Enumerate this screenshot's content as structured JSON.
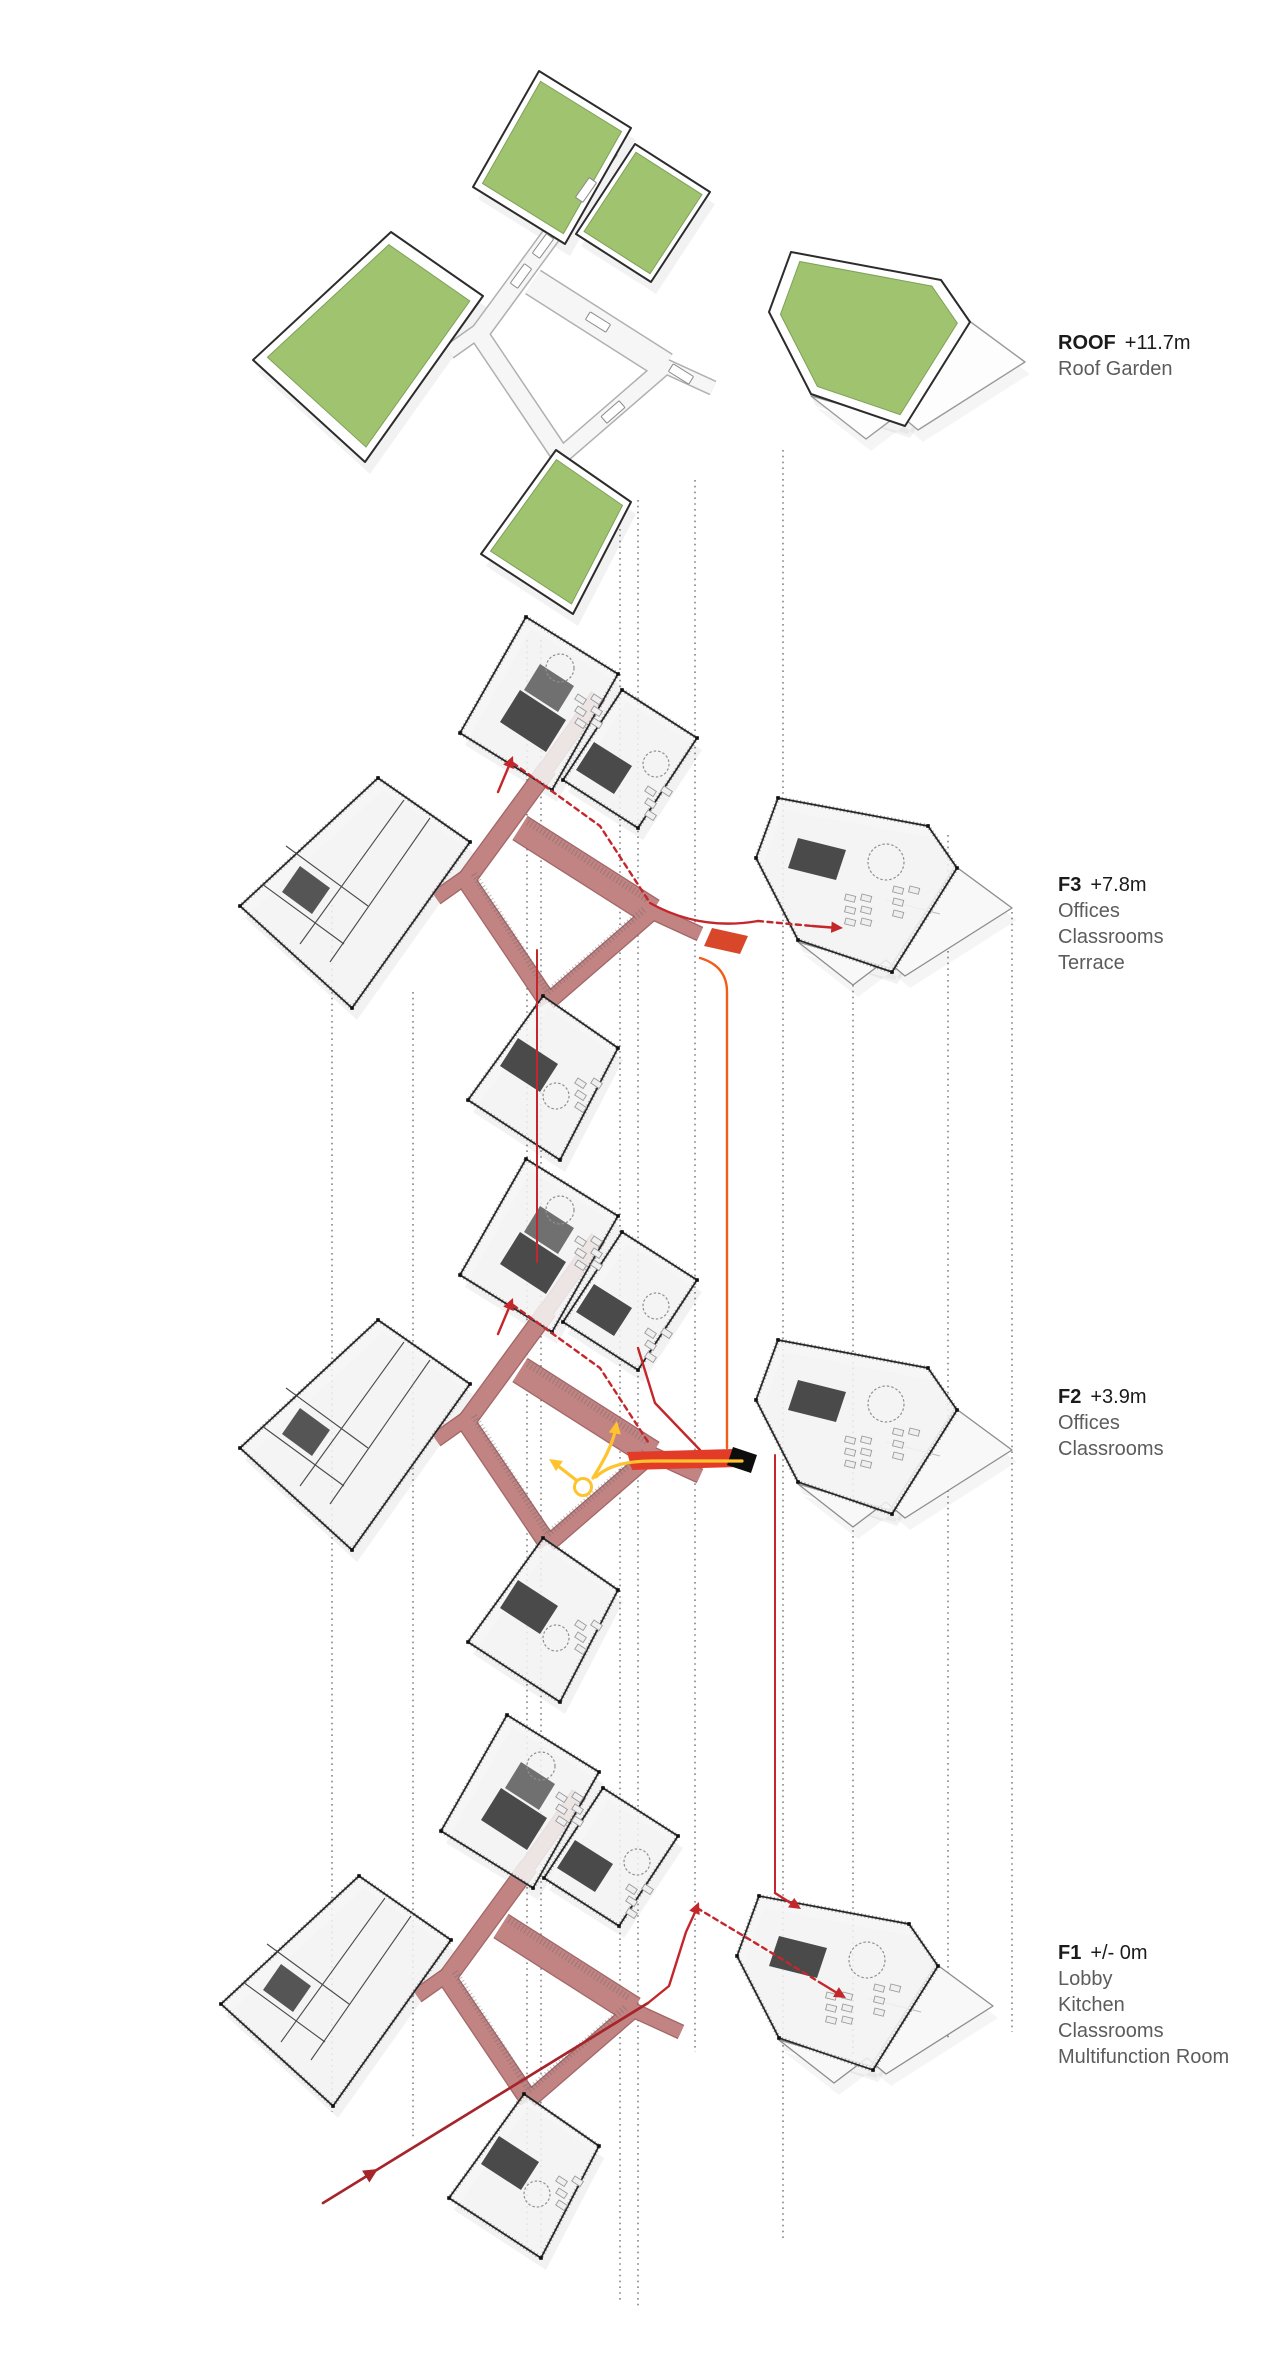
{
  "page": {
    "type": "exploded-axonometric-floor-diagram",
    "background": "#ffffff"
  },
  "colors": {
    "roof_green": "#9fc36f",
    "roof_green_edge": "#7ea257",
    "corridor_rose": "#c28383",
    "corridor_rose_edge": "#9e5f5f",
    "circulation_red": "#c3272b",
    "entry_red": "#a6252b",
    "ramp_red": "#e23b28",
    "stair_red": "#d9472b",
    "orange_line": "#f25c19",
    "yellow_path": "#fec32d",
    "wall_dark": "#262626",
    "slab_white": "#f5f5f6",
    "terrace_white": "#f8f8f8",
    "projection_dot": "#555555",
    "ink": "#1b1b1b",
    "label_gray": "#5c5c5c"
  },
  "levels": [
    {
      "id": "roof",
      "code": "ROOF",
      "elevation": "+11.7m",
      "programs": [
        "Roof Garden"
      ]
    },
    {
      "id": "f3",
      "code": "F3",
      "elevation": "+7.8m",
      "programs": [
        "Offices",
        "Classrooms",
        "Terrace"
      ]
    },
    {
      "id": "f2",
      "code": "F2",
      "elevation": "+3.9m",
      "programs": [
        "Offices",
        "Classrooms"
      ]
    },
    {
      "id": "f1",
      "code": "F1",
      "elevation": "+/- 0m",
      "programs": [
        "Lobby",
        "Kitchen",
        "Classrooms",
        "Multifunction Room"
      ]
    }
  ]
}
